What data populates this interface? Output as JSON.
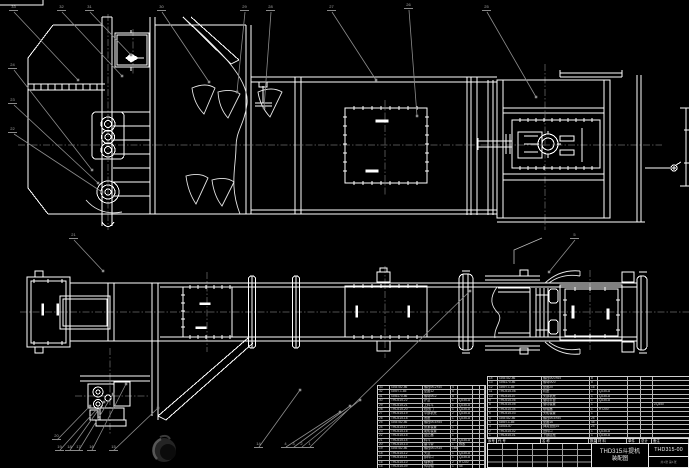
{
  "colors": {
    "background": "#000000",
    "line": "#ffffff",
    "leader": "#8c8c8c",
    "centerline": "#4f4f4f",
    "balloon_text": "#a8a8a8"
  },
  "title_block": {
    "product": "THD315斗提机",
    "sheet": "装配图",
    "number": "THD315-00",
    "note": "共1张 第1张"
  },
  "bom_right": {
    "header": [
      [
        "序号",
        "代  号",
        "名  称",
        "数量",
        "材  料",
        "单件",
        "总计",
        "备注"
      ]
    ],
    "rows": [
      [
        "14",
        "GB5782-86",
        "螺栓M20×65",
        "8",
        "",
        "",
        "",
        ""
      ],
      [
        "13",
        "GB6170-86",
        "螺母M20",
        "8",
        "",
        "",
        "",
        ""
      ],
      [
        "12",
        "GB97.1-85",
        "垫圈20",
        "16",
        "",
        "",
        "",
        ""
      ],
      [
        "11",
        "THD315-08",
        "机座",
        "1",
        "Q235-A",
        "",
        "",
        ""
      ],
      [
        "10",
        "THD315-07",
        "头部机壳",
        "1",
        "Q235-A",
        "",
        "",
        ""
      ],
      [
        "9",
        "THD315-06",
        "驱动平台",
        "1",
        "Q235-A",
        "",
        "",
        ""
      ],
      [
        "8",
        "THD315-05",
        "驱动装置",
        "1",
        "",
        "",
        "",
        "ZQ350"
      ],
      [
        "7",
        "THD315-04",
        "联轴器",
        "1",
        "HT200",
        "",
        "",
        ""
      ],
      [
        "6",
        "THD315-03",
        "头轮装置",
        "1",
        "",
        "",
        "",
        ""
      ],
      [
        "5",
        "GB5782-86",
        "螺栓M16×50",
        "24",
        "",
        "",
        "",
        ""
      ],
      [
        "4",
        "GB97.1-85",
        "垫圈16",
        "48",
        "",
        "",
        "",
        ""
      ],
      [
        "3",
        "GB93-87",
        "弹簧垫圈16",
        "24",
        "",
        "",
        "",
        ""
      ],
      [
        "2",
        "THD315-02",
        "进料口",
        "1",
        "Q235-A",
        "",
        "",
        ""
      ],
      [
        "1",
        "THD315-01",
        "下部区段",
        "1",
        "Q235-A",
        "",
        "",
        ""
      ]
    ]
  },
  "bom_left": {
    "rows": [
      [
        "33",
        "GB5782-86",
        "螺栓M12×40",
        "4",
        "",
        "",
        ""
      ],
      [
        "32",
        "GB97.1-85",
        "垫圈12",
        "8",
        "",
        "",
        ""
      ],
      [
        "31",
        "GB6170-86",
        "螺母M12",
        "8",
        "",
        "",
        ""
      ],
      [
        "30",
        "THD315-22",
        "护罩",
        "1",
        "Q235-A",
        "",
        ""
      ],
      [
        "29",
        "THD315-21",
        "上料斗",
        "1",
        "Q235-A",
        "",
        ""
      ],
      [
        "28",
        "THD315-20",
        "检视门",
        "1",
        "Q235-A",
        "",
        ""
      ],
      [
        "27",
        "THD315-19",
        "中部机壳",
        "2",
        "Q235-A",
        "",
        ""
      ],
      [
        "26",
        "THD315-18",
        "底座",
        "1",
        "Q235-A",
        "",
        ""
      ],
      [
        "25",
        "GB5782-86",
        "螺栓M16×55",
        "2",
        "",
        "",
        ""
      ],
      [
        "24",
        "THD315-17",
        "张紧装置",
        "1",
        "",
        "",
        ""
      ],
      [
        "23",
        "THD315-16",
        "尾轮装置",
        "1",
        "",
        "",
        ""
      ],
      [
        "22",
        "THD315-15",
        "逆止器",
        "1",
        "",
        "",
        ""
      ],
      [
        "21",
        "THD315-14",
        "料斗",
        "46",
        "Q235-A",
        "",
        ""
      ],
      [
        "20",
        "THD315-13",
        "畚斗带",
        "1",
        "橡胶",
        "",
        ""
      ],
      [
        "19",
        "GB5782-86",
        "螺栓M10×35",
        "184",
        "",
        "",
        ""
      ],
      [
        "18",
        "THD315-12",
        "头罩",
        "1",
        "Q235-A",
        "",
        ""
      ],
      [
        "17",
        "THD315-11",
        "卸料口",
        "1",
        "Q235-A",
        "",
        ""
      ],
      [
        "16",
        "THD315-10",
        "轴承座",
        "2",
        "HT200",
        "",
        ""
      ],
      [
        "15",
        "THD315-09",
        "传动轴",
        "1",
        "45",
        "",
        ""
      ]
    ]
  },
  "balloons": [
    {
      "n": "33",
      "x": 9,
      "y": 5
    },
    {
      "n": "32",
      "x": 57,
      "y": 5
    },
    {
      "n": "31",
      "x": 85,
      "y": 5
    },
    {
      "n": "30",
      "x": 157,
      "y": 5
    },
    {
      "n": "29",
      "x": 240,
      "y": 5
    },
    {
      "n": "28",
      "x": 266,
      "y": 5
    },
    {
      "n": "27",
      "x": 327,
      "y": 5
    },
    {
      "n": "26",
      "x": 404,
      "y": 3
    },
    {
      "n": "25",
      "x": 482,
      "y": 5
    },
    {
      "n": "24",
      "x": 8,
      "y": 63
    },
    {
      "n": "23",
      "x": 8,
      "y": 98
    },
    {
      "n": "22",
      "x": 8,
      "y": 127
    },
    {
      "n": "21",
      "x": 69,
      "y": 233
    },
    {
      "n": "5",
      "x": 570,
      "y": 233
    },
    {
      "n": "20",
      "x": 52,
      "y": 434
    },
    {
      "n": "19",
      "x": 55,
      "y": 445
    },
    {
      "n": "18",
      "x": 65,
      "y": 445
    },
    {
      "n": "17",
      "x": 74,
      "y": 445
    },
    {
      "n": "16",
      "x": 87,
      "y": 445
    },
    {
      "n": "15",
      "x": 109,
      "y": 445
    },
    {
      "n": "14",
      "x": 254,
      "y": 442
    },
    {
      "n": "4",
      "x": 281,
      "y": 442
    },
    {
      "n": "3",
      "x": 289,
      "y": 442
    },
    {
      "n": "2",
      "x": 297,
      "y": 442
    },
    {
      "n": "1",
      "x": 305,
      "y": 442
    }
  ]
}
